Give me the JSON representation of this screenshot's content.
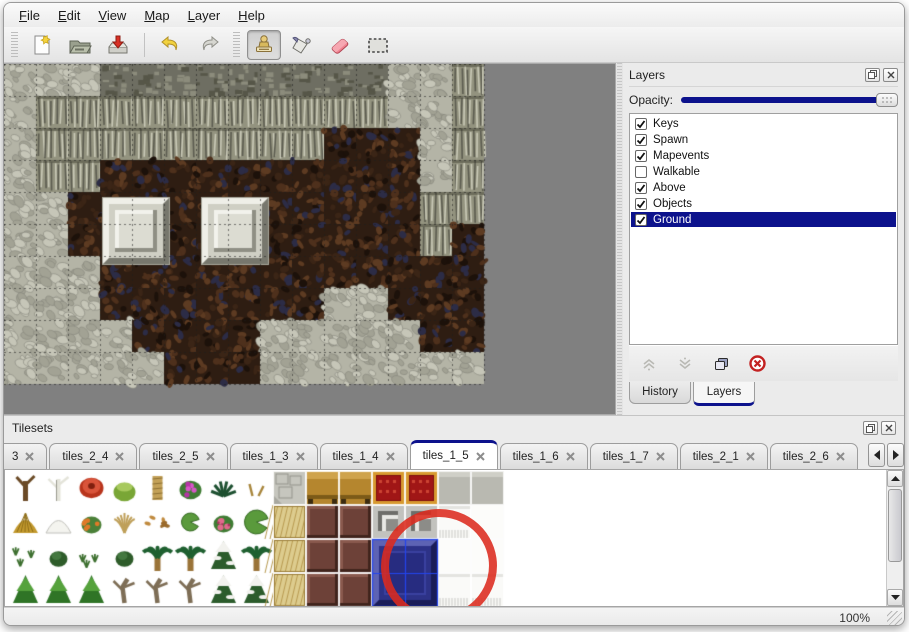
{
  "window_title": "Map Editor",
  "colors": {
    "accent_navy": "#0c128c",
    "annotation_red": "#dc2a1e",
    "eraser_pink": "#ef8290",
    "canvas_gray": "#808080",
    "selected_tile_blue": "#2d3287"
  },
  "menu": {
    "items": [
      {
        "label": "File"
      },
      {
        "label": "Edit"
      },
      {
        "label": "View"
      },
      {
        "label": "Map"
      },
      {
        "label": "Layer"
      },
      {
        "label": "Help"
      }
    ]
  },
  "toolbar": {
    "buttons": [
      {
        "icon": "new-file-icon",
        "selected": false
      },
      {
        "icon": "open-folder-icon",
        "selected": false
      },
      {
        "icon": "save-icon",
        "selected": false
      },
      {
        "icon": "undo-icon",
        "selected": false
      },
      {
        "icon": "redo-icon",
        "selected": false
      },
      {
        "icon": "stamp-tool-icon",
        "selected": true
      },
      {
        "icon": "fill-tool-icon",
        "selected": false
      },
      {
        "icon": "eraser-tool-icon",
        "selected": false
      },
      {
        "icon": "select-tool-icon",
        "selected": false
      }
    ]
  },
  "layers_panel": {
    "title": "Layers",
    "opacity_label": "Opacity:",
    "opacity_fraction": 1.0,
    "layers": [
      {
        "name": "Keys",
        "checked": true,
        "selected": false
      },
      {
        "name": "Spawn",
        "checked": true,
        "selected": false
      },
      {
        "name": "Mapevents",
        "checked": true,
        "selected": false
      },
      {
        "name": "Walkable",
        "checked": false,
        "selected": false
      },
      {
        "name": "Above",
        "checked": true,
        "selected": false
      },
      {
        "name": "Objects",
        "checked": true,
        "selected": false
      },
      {
        "name": "Ground",
        "checked": true,
        "selected": true
      }
    ],
    "tool_icons": [
      "move-up-icon",
      "move-down-icon",
      "duplicate-icon",
      "delete-icon"
    ],
    "tabs": [
      {
        "label": "History",
        "active": false
      },
      {
        "label": "Layers",
        "active": true
      }
    ]
  },
  "tilesets_panel": {
    "title": "Tilesets",
    "tabs": [
      {
        "label": "3",
        "active": false,
        "partial": true
      },
      {
        "label": "tiles_2_4",
        "active": false,
        "partial": false
      },
      {
        "label": "tiles_2_5",
        "active": false,
        "partial": false
      },
      {
        "label": "tiles_1_3",
        "active": false,
        "partial": false
      },
      {
        "label": "tiles_1_4",
        "active": false,
        "partial": false
      },
      {
        "label": "tiles_1_5",
        "active": true,
        "partial": false
      },
      {
        "label": "tiles_1_6",
        "active": false,
        "partial": false
      },
      {
        "label": "tiles_1_7",
        "active": false,
        "partial": false
      },
      {
        "label": "tiles_2_1",
        "active": false,
        "partial": false
      },
      {
        "label": "tiles_2_6",
        "active": false,
        "partial": false
      }
    ]
  },
  "status_bar": {
    "zoom": "100%"
  },
  "map": {
    "tile_size": 32,
    "grid": [
      "CCCRRRRRRRRRCCW",
      "CWWWWWWWWWWWCCW",
      "CWWWWWWWWWFFFCW",
      "CWWFFFFFFFFFFCW",
      "CCFFFFFFFFFFFWW",
      "CCFFFFFFFFFFFWF",
      "CCCFFFFFFFFFFFF",
      "CCCFFFFFFFCCFFF",
      "CCCCFFFFCCCCCFF",
      "CCCCCFFFCCCCCCC"
    ],
    "platforms": [
      {
        "x": 99,
        "y": 134
      },
      {
        "x": 198,
        "y": 134
      }
    ]
  },
  "tileset": {
    "cell_w": 33,
    "cell_h": 34,
    "rows": [
      [
        "trunk",
        "birch",
        "flower-red",
        "stump",
        "palm-trunk",
        "bush-pink",
        "fern",
        "sprout",
        "stone",
        "table-gold",
        "table-gold",
        "carpet-red",
        "carpet-red",
        "tile-gray",
        "tile-gray"
      ],
      [
        "hay",
        "snow-mound",
        "bush-orange",
        "dry-grass",
        "leaves",
        "lily",
        "bush-rose",
        "lily-big",
        "mat-tan",
        "block-maroon",
        "block-maroon",
        "metal",
        "metal",
        "white-fringe",
        "tile-white"
      ],
      [
        "sprigs",
        "bush-small",
        "sprigs",
        "bush-small",
        "palm",
        "palm",
        "pine-snow",
        "palm",
        "mat-tan",
        "block-maroon",
        "block-maroon",
        "blue",
        "blue",
        "tile-white",
        "tile-white"
      ],
      [
        "conifer",
        "conifer",
        "conifer",
        "dead-tree",
        "dead-tree",
        "dead-tree",
        "pine-snow",
        "pine-snow",
        "mat-tan",
        "block-maroon",
        "block-maroon",
        "blue",
        "blue",
        "white-fringe",
        "white-fringe"
      ]
    ],
    "blue_block": {
      "col": 11,
      "row": 2,
      "cols": 2,
      "rows": 2
    }
  },
  "annotation": {
    "shape": "ellipse",
    "cx": 434,
    "cy": 96,
    "rx": 54,
    "ry": 53,
    "rotation": -8
  }
}
